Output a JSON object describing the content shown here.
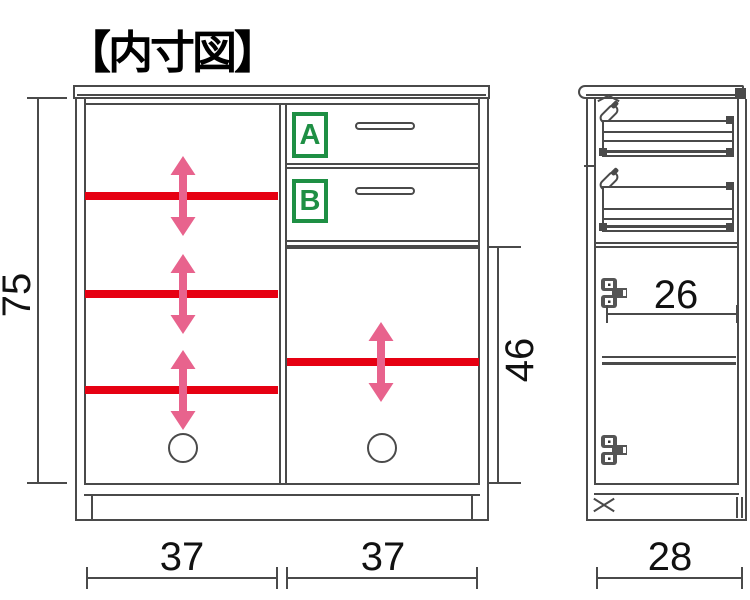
{
  "title": "【内寸図】",
  "colors": {
    "shelf_red": "#e60012",
    "arrow_pink": "#e8638d",
    "label_green": "#1e8f44",
    "line_gray": "#4a4a4a"
  },
  "front_view": {
    "inner_height": "75",
    "right_open_height": "46",
    "left_width": "37",
    "right_width": "37",
    "drawers": [
      {
        "label": "A"
      },
      {
        "label": "B"
      }
    ]
  },
  "side_view": {
    "inner_depth": "26",
    "outer_depth": "28"
  }
}
